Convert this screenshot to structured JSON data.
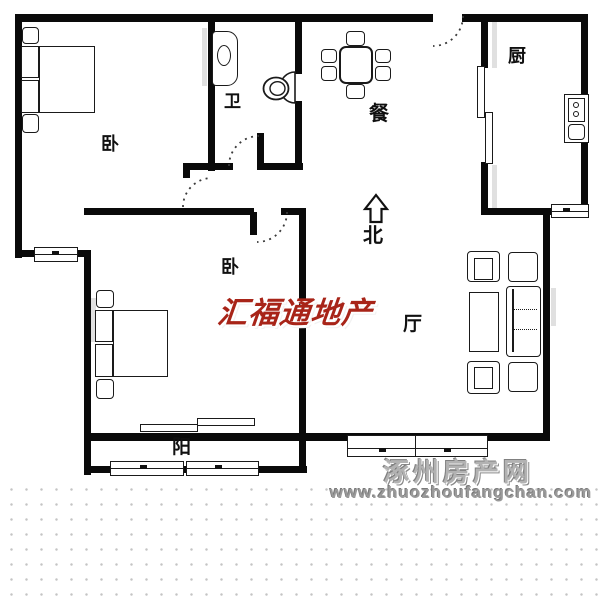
{
  "floorplan": {
    "rooms": [
      {
        "id": "bedroom-1",
        "label": "卧"
      },
      {
        "id": "bedroom-2",
        "label": "卧"
      },
      {
        "id": "bathroom",
        "label": "卫"
      },
      {
        "id": "dining",
        "label": "餐"
      },
      {
        "id": "kitchen",
        "label": "厨"
      },
      {
        "id": "living",
        "label": "厅"
      },
      {
        "id": "balcony",
        "label": "阳"
      }
    ],
    "compass": {
      "label": "北"
    }
  },
  "watermarks": {
    "agency": {
      "text": "汇福通地产",
      "color": "#a82418"
    },
    "site": {
      "name": "涿州房产网",
      "url": "www.zhuozhoufangchan.com",
      "color": "#b2b2b2"
    }
  },
  "colors": {
    "wall": "#0a0a0a",
    "background": "#ffffff",
    "dots": "#c4c4c4"
  }
}
